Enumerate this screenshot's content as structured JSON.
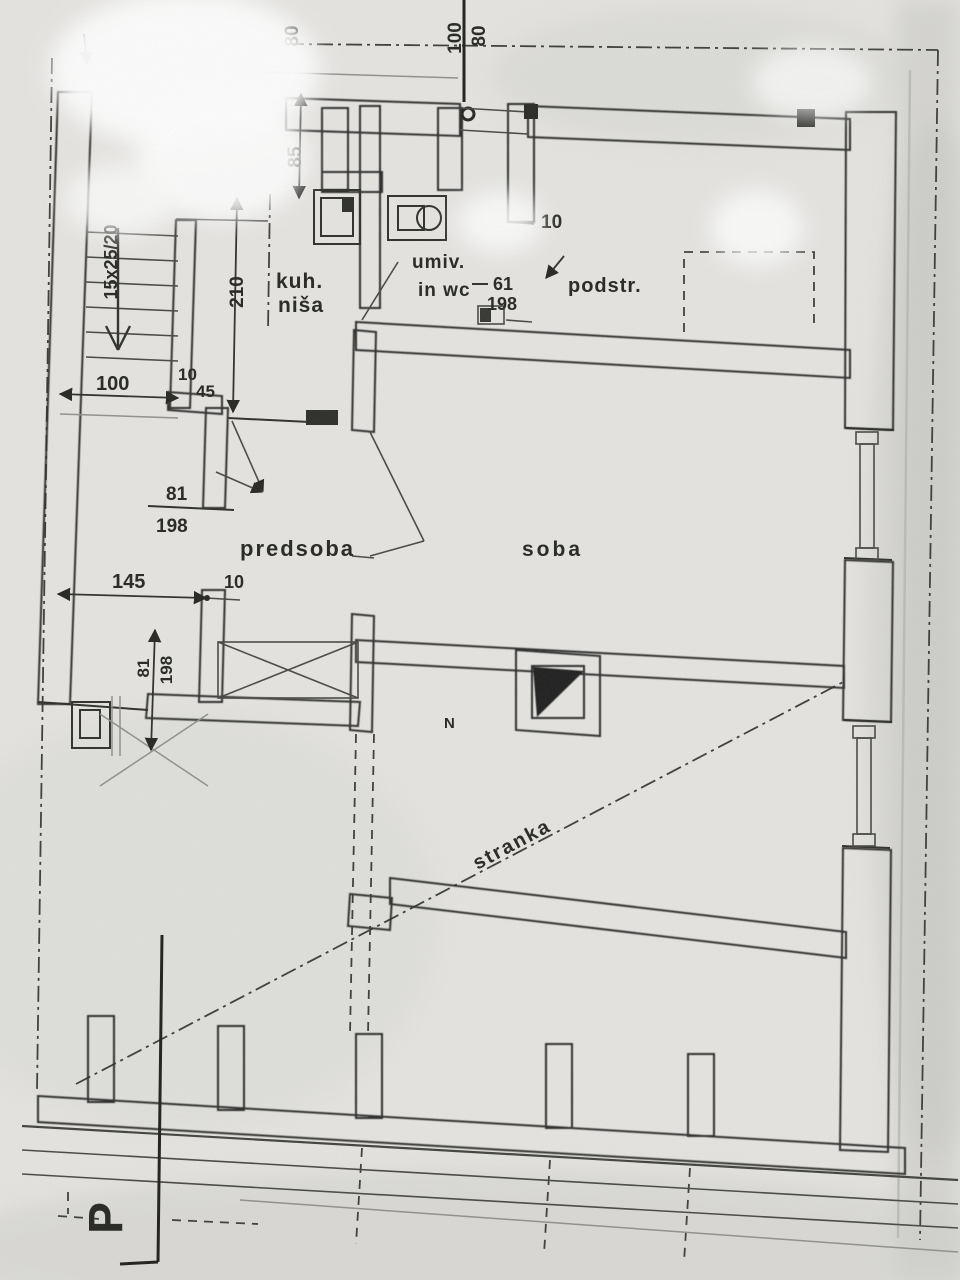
{
  "labels": {
    "kitchen_niche_line1": "kuh.",
    "kitchen_niche_line2": "niša",
    "washbasin_wc_line1": "umiv.",
    "washbasin_wc_line2": "in wc",
    "attic": "podstr.",
    "anteroom": "predsoba",
    "room": "soba",
    "party_line": "stranka",
    "floor_mark": "P",
    "north_mark": "N"
  },
  "dimensions": {
    "left_parapet": "80",
    "window_width_top": "100",
    "window_parapet_top": "80",
    "wc_niche_width": "85",
    "stairs_spec": "15x25/20",
    "niche_length": "210",
    "stairs_width": "100",
    "jamb_top": "10",
    "wall_stub": "45",
    "door_upper_width": "81",
    "door_upper_height": "198",
    "wall_length": "145",
    "jamb_mid": "10",
    "door_lower_width": "81",
    "door_lower_height": "198",
    "door_wc_width": "61",
    "door_wc_height": "198",
    "jamb_attic": "10"
  },
  "colors": {
    "paper": "#e6e5e2",
    "ink": "#23231f",
    "shade_gray": "#c6c6c2"
  }
}
